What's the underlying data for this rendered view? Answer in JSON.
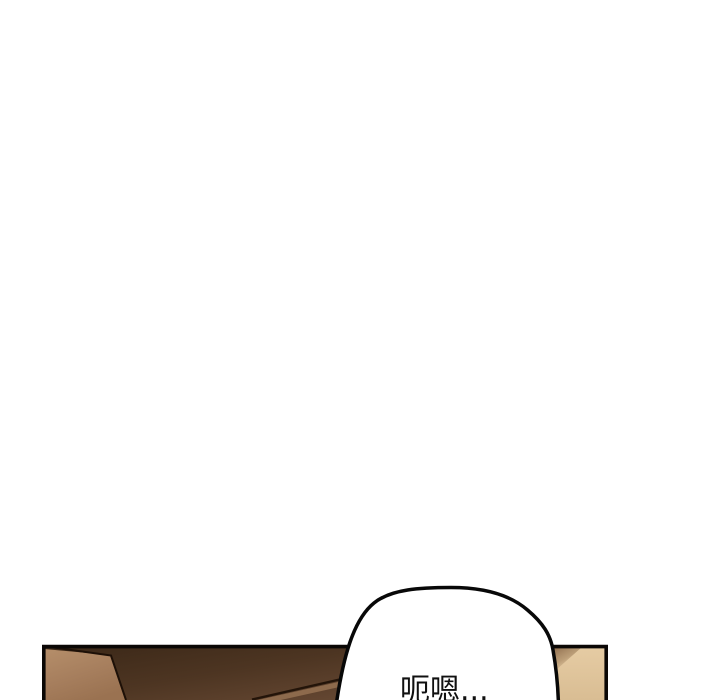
{
  "page": {
    "background_color": "#ffffff",
    "kind": "comic-panel-strip"
  },
  "panel": {
    "border_color": "#0a0705",
    "colors": {
      "dark_furniture_face_start": "#3a2717",
      "dark_furniture_face_mid": "#4d3522",
      "dark_furniture_face_end": "#6f4f39",
      "light_furniture_side_top": "#b48d69",
      "light_furniture_side_bottom": "#9a7251",
      "furniture_edge_line": "#1d1007",
      "highlight_strip": "#8d6a4c",
      "highlight_strip_shadow_line": "#231409",
      "tan_wall_top": "#e6cca4",
      "tan_wall_bottom": "#d9bd93",
      "tan_wall_corner_shading": "#7a573b"
    }
  },
  "bubble": {
    "text": "呃嗯...",
    "fill_color": "#ffffff",
    "stroke_color": "#080808",
    "text_color": "#101010"
  }
}
